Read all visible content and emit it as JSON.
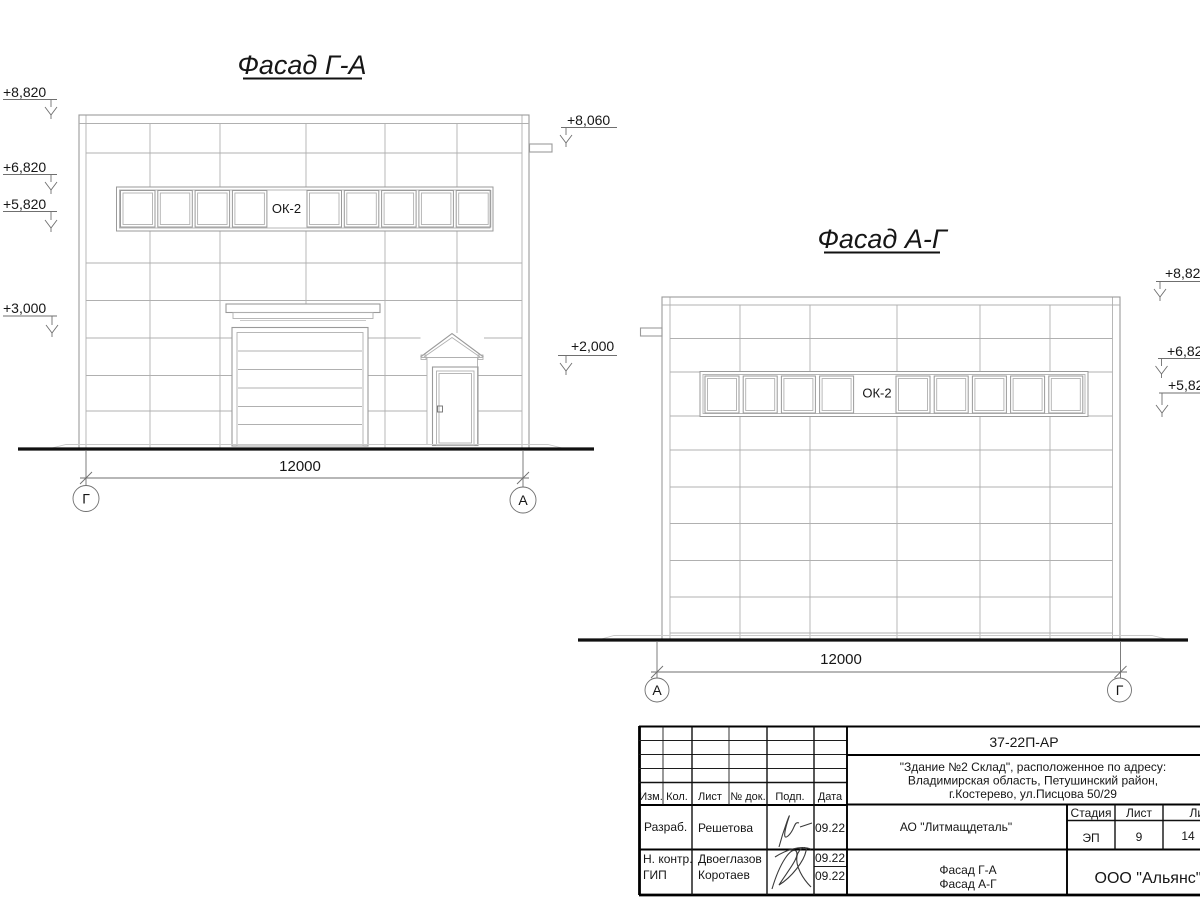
{
  "colors": {
    "background": "#ffffff",
    "drawing_line": "#9a9a9a",
    "ink": "#161616",
    "frame_line": "#000000"
  },
  "left_facade": {
    "title": "Фасад Г-А",
    "window_label": "ОК-2",
    "dimension_label": "12000",
    "axis_left": "Г",
    "axis_right": "А",
    "elevations": {
      "m8820": "+8,820",
      "m6820": "+6,820",
      "m5820": "+5,820",
      "m3000": "+3,000",
      "m8060": "+8,060",
      "m2000": "+2,000"
    }
  },
  "right_facade": {
    "title": "Фасад А-Г",
    "window_label": "ОК-2",
    "dimension_label": "12000",
    "axis_left": "А",
    "axis_right": "Г",
    "elevations": {
      "m882": "+8,82",
      "m682": "+6,82",
      "m582": "+5,82"
    }
  },
  "title_block": {
    "doc_number": "37-22П-АР",
    "address_line1": "\"Здание №2 Склад\", расположенное по адресу:",
    "address_line2": "Владимирская область, Петушинский район,",
    "address_line3": "г.Костерево, ул.Писцова 50/29",
    "client": "АО \"Литмащдеталь\"",
    "sheet_title_line1": "Фасад Г-А",
    "sheet_title_line2": "Фасад А-Г",
    "company": "ООО \"Альянс\"",
    "stage_label": "Стадия",
    "sheet_label": "Лист",
    "sheets_label": "Листов",
    "stage_value": "ЭП",
    "sheet_value": "9",
    "sheets_value": "14",
    "columns": [
      "Изм.",
      "Кол.",
      "Лист",
      "№ док.",
      "Подп.",
      "Дата"
    ],
    "rows": [
      {
        "role": "Разраб.",
        "name": "Решетова",
        "date": "09.22"
      },
      {
        "role": "Н. контр.",
        "name": "Двоеглазов",
        "date": "09.22"
      },
      {
        "role": "ГИП",
        "name": "Коротаев",
        "date": "09.22"
      }
    ]
  }
}
